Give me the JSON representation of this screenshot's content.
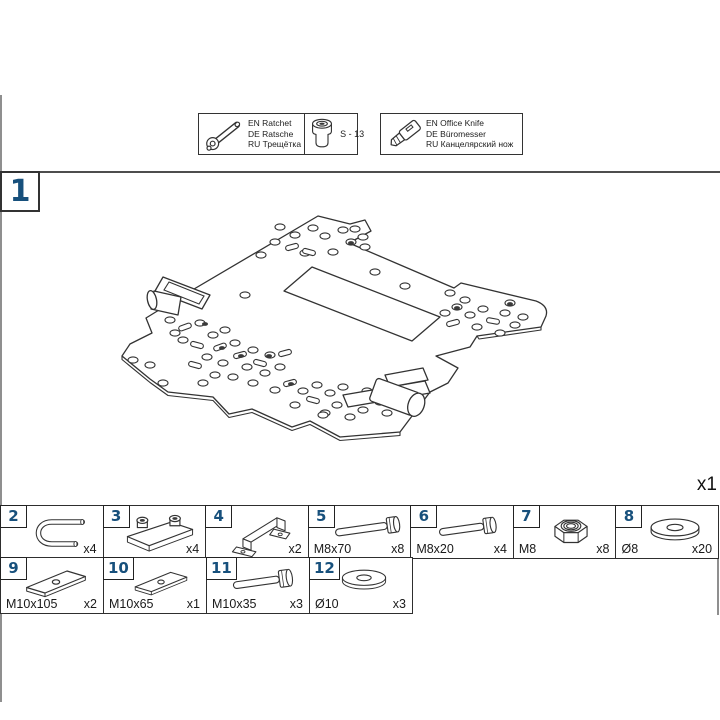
{
  "page": {
    "step_number": "1",
    "main_part_quantity": "x1"
  },
  "tools": {
    "ratchet": {
      "icon": "ratchet-icon",
      "lines": [
        "EN Ratchet",
        "DE Ratsche",
        "RU Трещётка"
      ]
    },
    "socket": {
      "icon": "socket-icon",
      "label": "S - 13"
    },
    "knife": {
      "icon": "office-knife-icon",
      "lines": [
        "EN Office Knife",
        "DE Büromesser",
        "RU Канцелярский нож"
      ]
    }
  },
  "parts": {
    "row1": [
      {
        "num": "2",
        "size": "",
        "qty": "x4",
        "icon": "u-bolt-icon"
      },
      {
        "num": "3",
        "size": "",
        "qty": "x4",
        "icon": "clamp-block-icon"
      },
      {
        "num": "4",
        "size": "",
        "qty": "x2",
        "icon": "handle-bracket-icon"
      },
      {
        "num": "5",
        "size": "M8x70",
        "qty": "x8",
        "icon": "hex-bolt-icon"
      },
      {
        "num": "6",
        "size": "M8x20",
        "qty": "x4",
        "icon": "hex-bolt-icon"
      },
      {
        "num": "7",
        "size": "M8",
        "qty": "x8",
        "icon": "lock-nut-icon"
      },
      {
        "num": "8",
        "size": "Ø8",
        "qty": "x20",
        "icon": "washer-icon"
      }
    ],
    "row2": [
      {
        "num": "9",
        "size": "M10x105",
        "qty": "x2",
        "icon": "spacer-plate-icon"
      },
      {
        "num": "10",
        "size": "M10x65",
        "qty": "x1",
        "icon": "spacer-plate-icon"
      },
      {
        "num": "11",
        "size": "M10x35",
        "qty": "x3",
        "icon": "hex-bolt-icon"
      },
      {
        "num": "12",
        "size": "Ø10",
        "qty": "x3",
        "icon": "washer-icon"
      }
    ]
  },
  "colors": {
    "accent_navy": "#17507c",
    "line": "#333333",
    "frame_gray": "#8f8f8f"
  }
}
